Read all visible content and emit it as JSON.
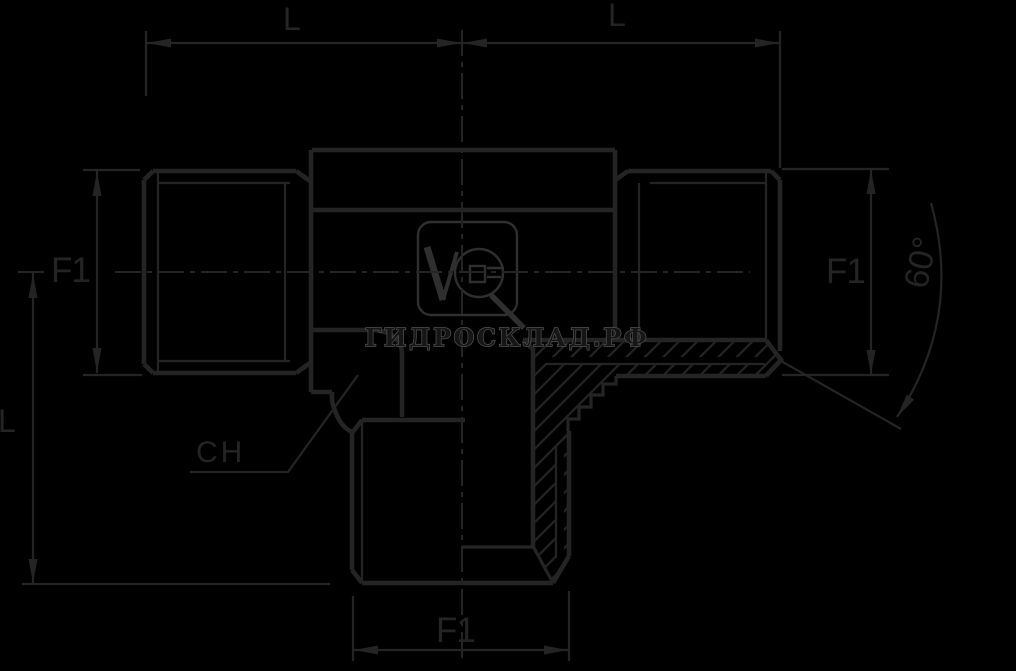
{
  "drawing": {
    "type": "male tee hydraulic fitting - dimensioned technical drawing",
    "labels": {
      "top_left_length": "L",
      "top_right_length": "L",
      "left_thread": "F1",
      "right_thread": "F1",
      "bottom_thread": "F1",
      "cone_angle": "60°",
      "wrench_flats": "CH",
      "branch_length": "L"
    }
  },
  "watermark": {
    "text": "ГИДРОСКЛАД.РФ",
    "logo": "VG"
  },
  "colors": {
    "background": "#000000",
    "ink": "#242424",
    "watermark_outline": "#525252",
    "watermark_fill": "#161616",
    "logo": "#2f2f2f"
  }
}
